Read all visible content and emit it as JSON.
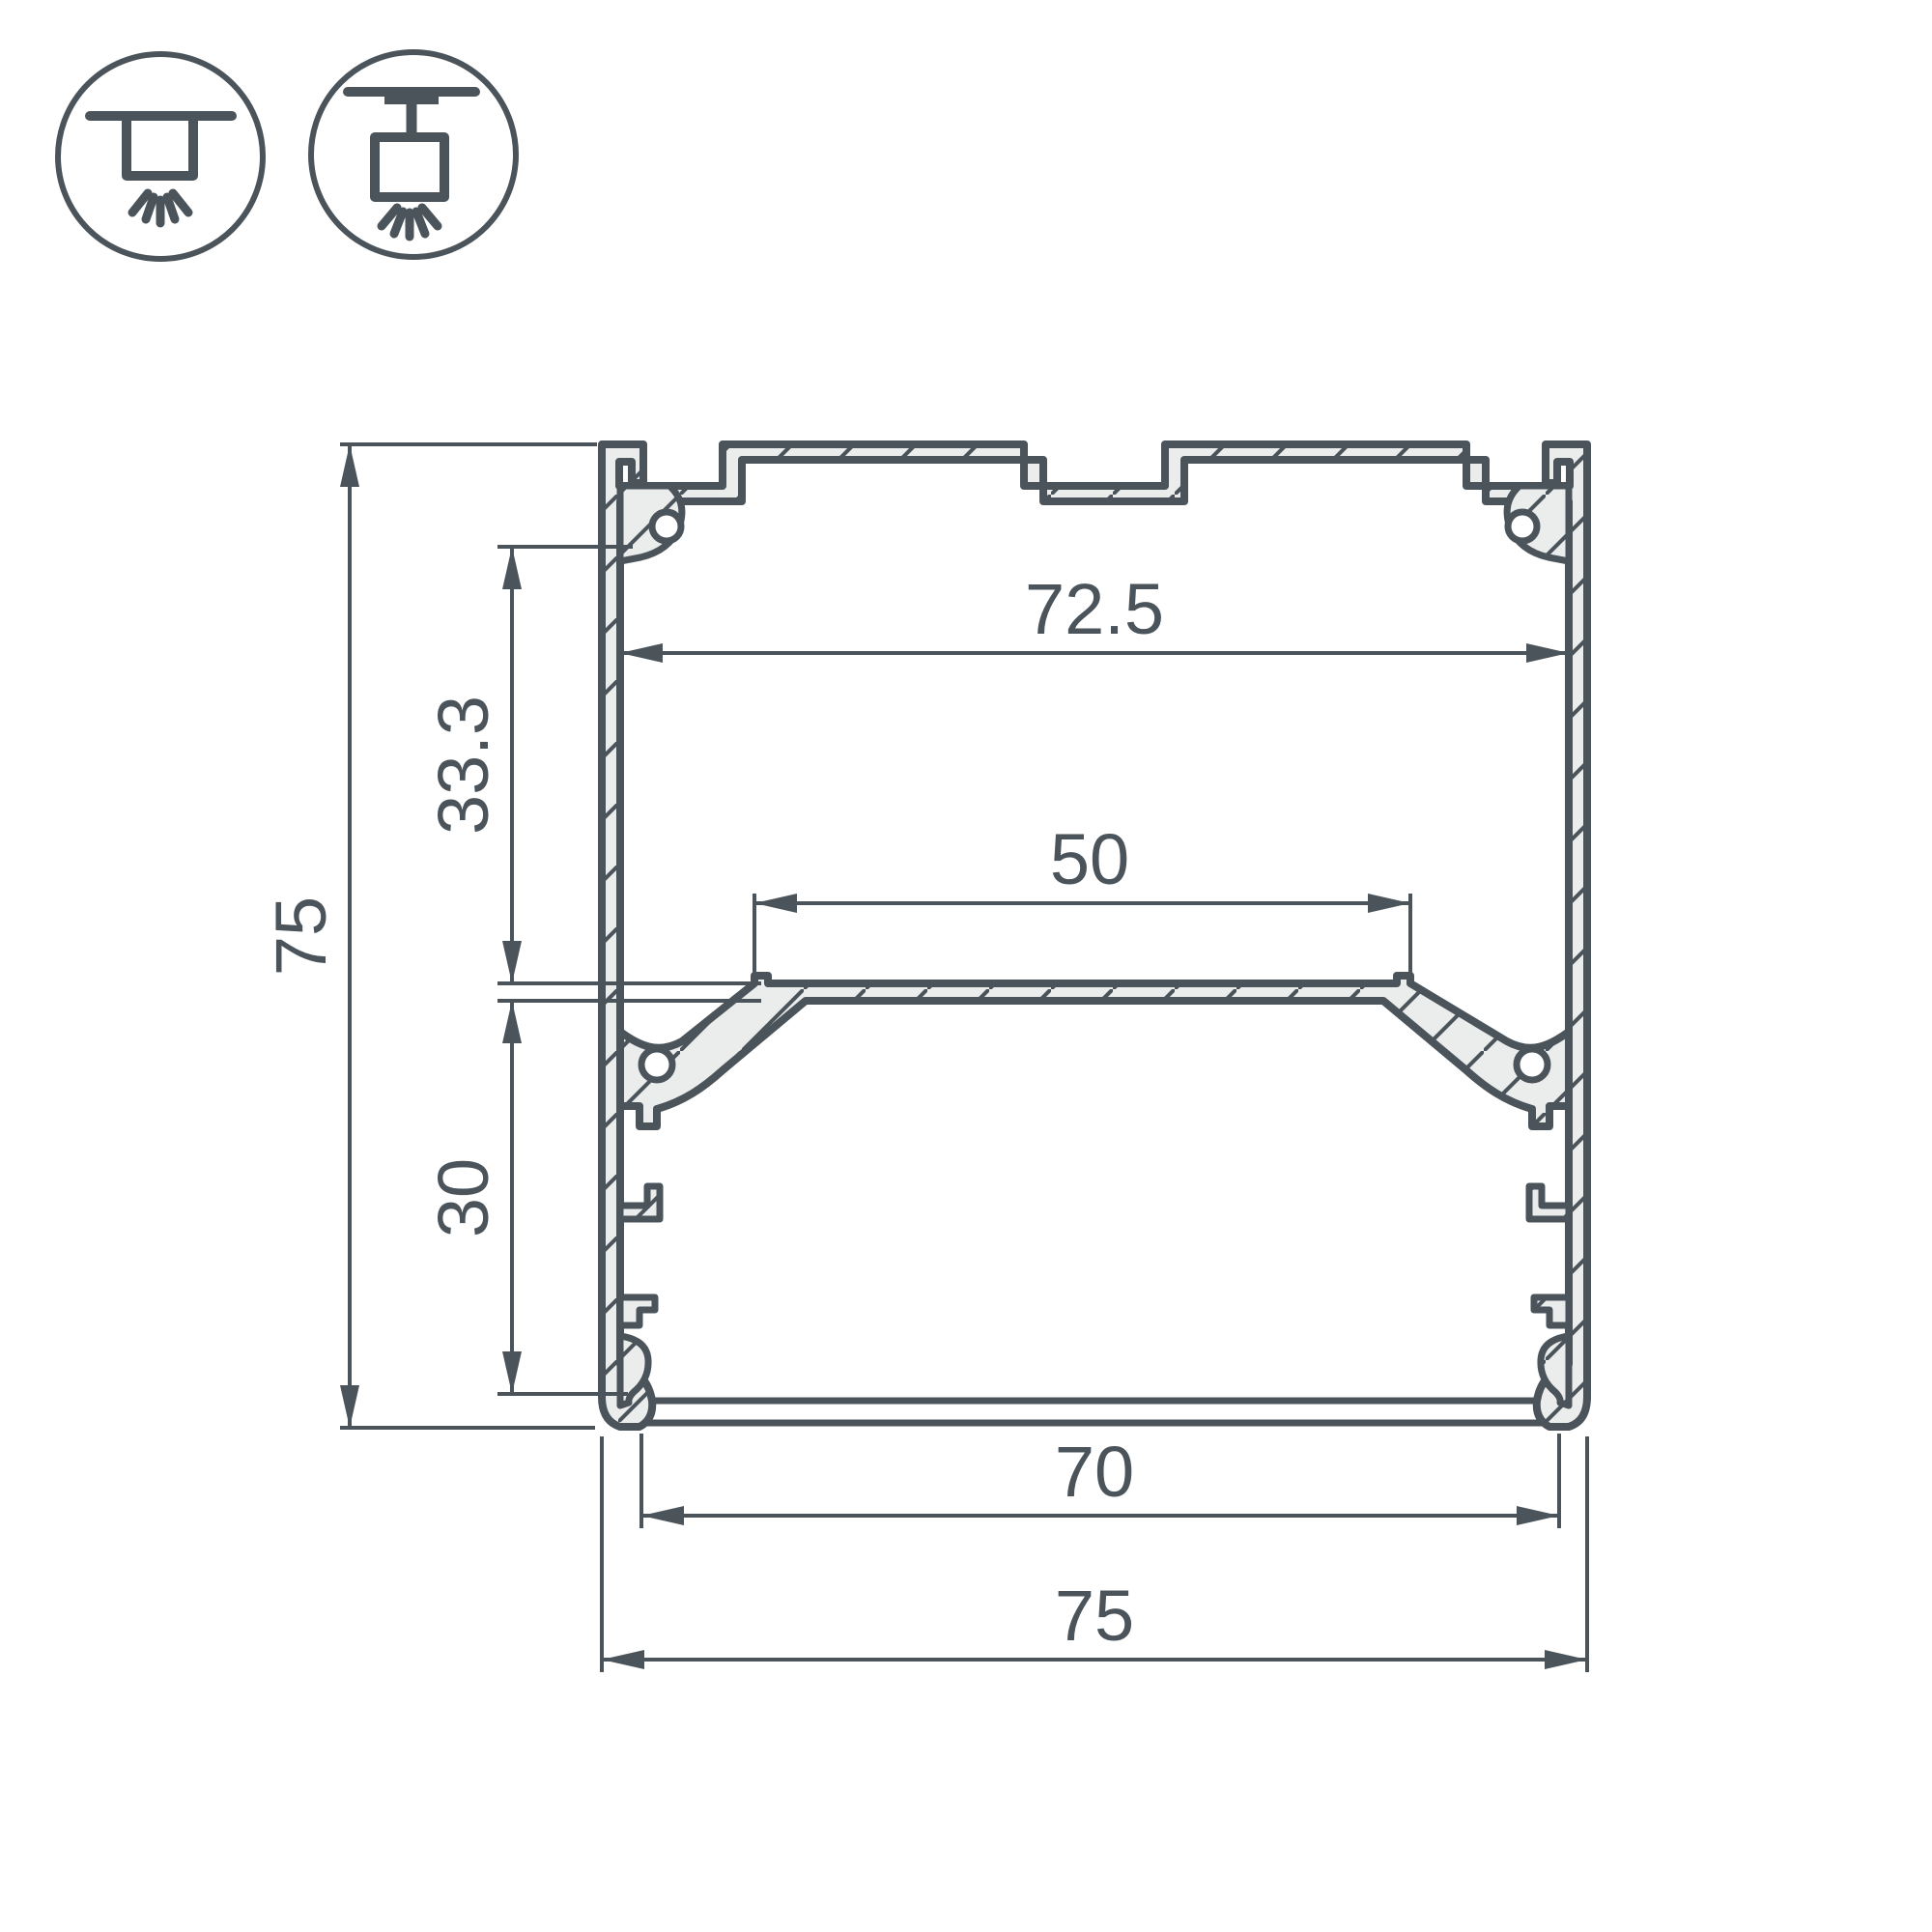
{
  "icons": {
    "surface_mount": "surface-mount-icon",
    "pendant_mount": "pendant-mount-icon"
  },
  "dimensions": {
    "total_height": "75",
    "upper_inner_height": "33.3",
    "lower_inner_height": "30",
    "top_inner_width": "72.5",
    "led_platform_width": "50",
    "bottom_opening_width": "70",
    "total_width": "75"
  },
  "colors": {
    "line": "#4b545b",
    "aluminum_fill": "#ebecec",
    "background": "#ffffff"
  }
}
